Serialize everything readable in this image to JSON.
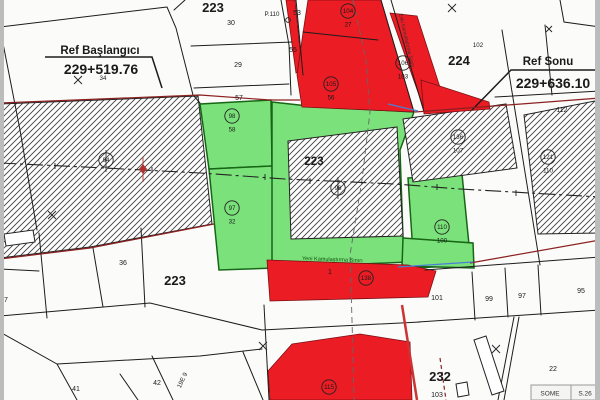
{
  "ref_start": {
    "label": "Ref Başlangıcı",
    "value": "229+519.76"
  },
  "ref_end": {
    "label": "Ref Sonu",
    "value": "229+636.10"
  },
  "roads": {
    "old_boundary": "Eski Kamulaştırma Sınırı",
    "new_boundary": "Yeni Kamulaştırma Sınırı"
  },
  "labels": {
    "b223_tl": "223",
    "b223_c": "223",
    "b223_bl": "223",
    "b224": "224",
    "b232": "232",
    "n30": "30",
    "n29": "29",
    "n55": "55",
    "n57": "57",
    "n34": "34",
    "p110": "P.110",
    "n53": "53",
    "n102": "102",
    "n112": "112",
    "n36": "36",
    "n7": "7",
    "n41": "41",
    "n42": "42",
    "n1": "1",
    "n101": "101",
    "n99": "99",
    "n97": "97",
    "n95": "95",
    "n22": "22",
    "n103": "103",
    "sheet": "19E 9"
  },
  "stations": {
    "s94": {
      "num": "94"
    },
    "s96": {
      "num": "96"
    },
    "s98": {
      "num": "98",
      "sub": "58"
    },
    "s97": {
      "num": "97",
      "sub": "32"
    },
    "s104": {
      "num": "104",
      "sub": "27"
    },
    "s105": {
      "num": "105",
      "sub": "56"
    },
    "s106": {
      "num": "106",
      "sub": "103"
    },
    "s110": {
      "num": "110",
      "sub": "100"
    },
    "s136": {
      "num": "136",
      "sub": "107"
    },
    "s121": {
      "num": "121",
      "sub": "110"
    },
    "s138": {
      "num": "138"
    },
    "s115": {
      "num": "115"
    }
  },
  "table": {
    "col1": "SOME",
    "col2": "S.26"
  },
  "colors": {
    "red": "#ec1c24",
    "green": "#7be27b",
    "hatch_line": "#3f3f3f",
    "boundary_red": "#8b2020",
    "blue": "#4a7fd4",
    "centerline": "#222222"
  }
}
